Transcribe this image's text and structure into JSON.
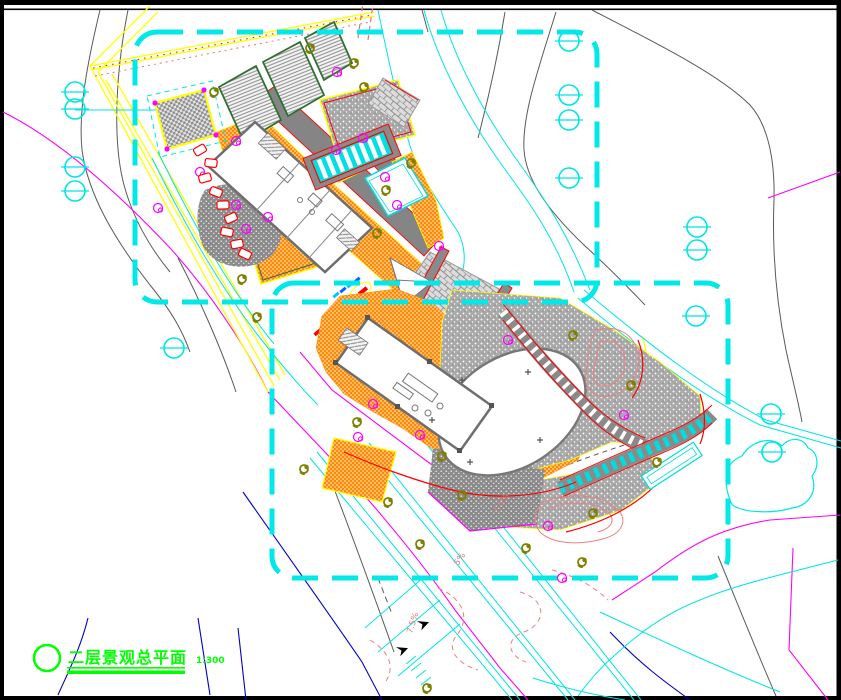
{
  "frame": {
    "bg": "#ffffff",
    "border": "#000000"
  },
  "title_block": {
    "symbol": "circle",
    "title": "二层景观总平面",
    "scale_label": "1:300",
    "color": "#00ff00"
  },
  "annotations": {
    "color": "#e07878",
    "slope_labels": [
      {
        "text": "7.5%",
        "x": 497,
        "y": 514,
        "rot": -55
      },
      {
        "text": "5%",
        "x": 458,
        "y": 566,
        "rot": -55
      },
      {
        "text": "7.5%",
        "x": 412,
        "y": 634,
        "rot": -72
      }
    ]
  },
  "palette": {
    "boundary_dash": "#00e8e8",
    "road_yellow": "#ffff00",
    "contour_magenta": "#ff00ff",
    "contour_blue": "#0000c8",
    "contour_gray": "#5a5a5a",
    "paving_orange": "#ff8a00",
    "accent_red": "#ff0000",
    "tree_olive": "#7f7f00",
    "tree_cyan": "#00e5e5",
    "flower_magenta": "#ff00ff",
    "stone_gray": "#9b9b9b",
    "title_green": "#00ff00",
    "garden_salmon": "#ee8080",
    "panel_green": "#2f7032"
  },
  "symbols": {
    "cyan_trees": [
      [
        75,
        92
      ],
      [
        75,
        109
      ],
      [
        75,
        167
      ],
      [
        75,
        191
      ],
      [
        569,
        41
      ],
      [
        569,
        95
      ],
      [
        569,
        120
      ],
      [
        569,
        178
      ],
      [
        697,
        227
      ],
      [
        697,
        250
      ],
      [
        174,
        348
      ],
      [
        696,
        316
      ],
      [
        771,
        414
      ],
      [
        772,
        452
      ]
    ],
    "olive_trees": [
      [
        310,
        48
      ],
      [
        354,
        63
      ],
      [
        364,
        87
      ],
      [
        214,
        92
      ],
      [
        411,
        163
      ],
      [
        386,
        190
      ],
      [
        377,
        233
      ],
      [
        242,
        279
      ],
      [
        257,
        317
      ],
      [
        573,
        335
      ],
      [
        631,
        385
      ],
      [
        657,
        462
      ],
      [
        593,
        513
      ],
      [
        526,
        548
      ],
      [
        582,
        562
      ],
      [
        462,
        495
      ],
      [
        388,
        502
      ],
      [
        420,
        544
      ],
      [
        442,
        456
      ],
      [
        357,
        422
      ],
      [
        427,
        688
      ],
      [
        304,
        469
      ]
    ],
    "magenta_flowers": [
      [
        337,
        72
      ],
      [
        236,
        141
      ],
      [
        336,
        150
      ],
      [
        363,
        138
      ],
      [
        385,
        177
      ],
      [
        397,
        205
      ],
      [
        268,
        217
      ],
      [
        246,
        229
      ],
      [
        439,
        246
      ],
      [
        200,
        172
      ],
      [
        158,
        208
      ],
      [
        508,
        340
      ],
      [
        624,
        415
      ],
      [
        548,
        526
      ],
      [
        373,
        404
      ],
      [
        358,
        437
      ],
      [
        420,
        435
      ],
      [
        562,
        578
      ],
      [
        236,
        205
      ]
    ],
    "red_stones": [
      [
        200,
        150
      ],
      [
        211,
        163
      ],
      [
        205,
        178
      ],
      [
        216,
        192
      ],
      [
        223,
        205
      ],
      [
        231,
        218
      ],
      [
        227,
        232
      ],
      [
        237,
        244
      ],
      [
        245,
        254
      ]
    ],
    "black_arrows": [
      [
        418,
        624,
        -20
      ],
      [
        397,
        650,
        -20
      ]
    ],
    "plus_marks": [
      [
        462,
        380
      ],
      [
        528,
        372
      ],
      [
        540,
        440
      ],
      [
        470,
        462
      ],
      [
        432,
        420
      ]
    ]
  }
}
